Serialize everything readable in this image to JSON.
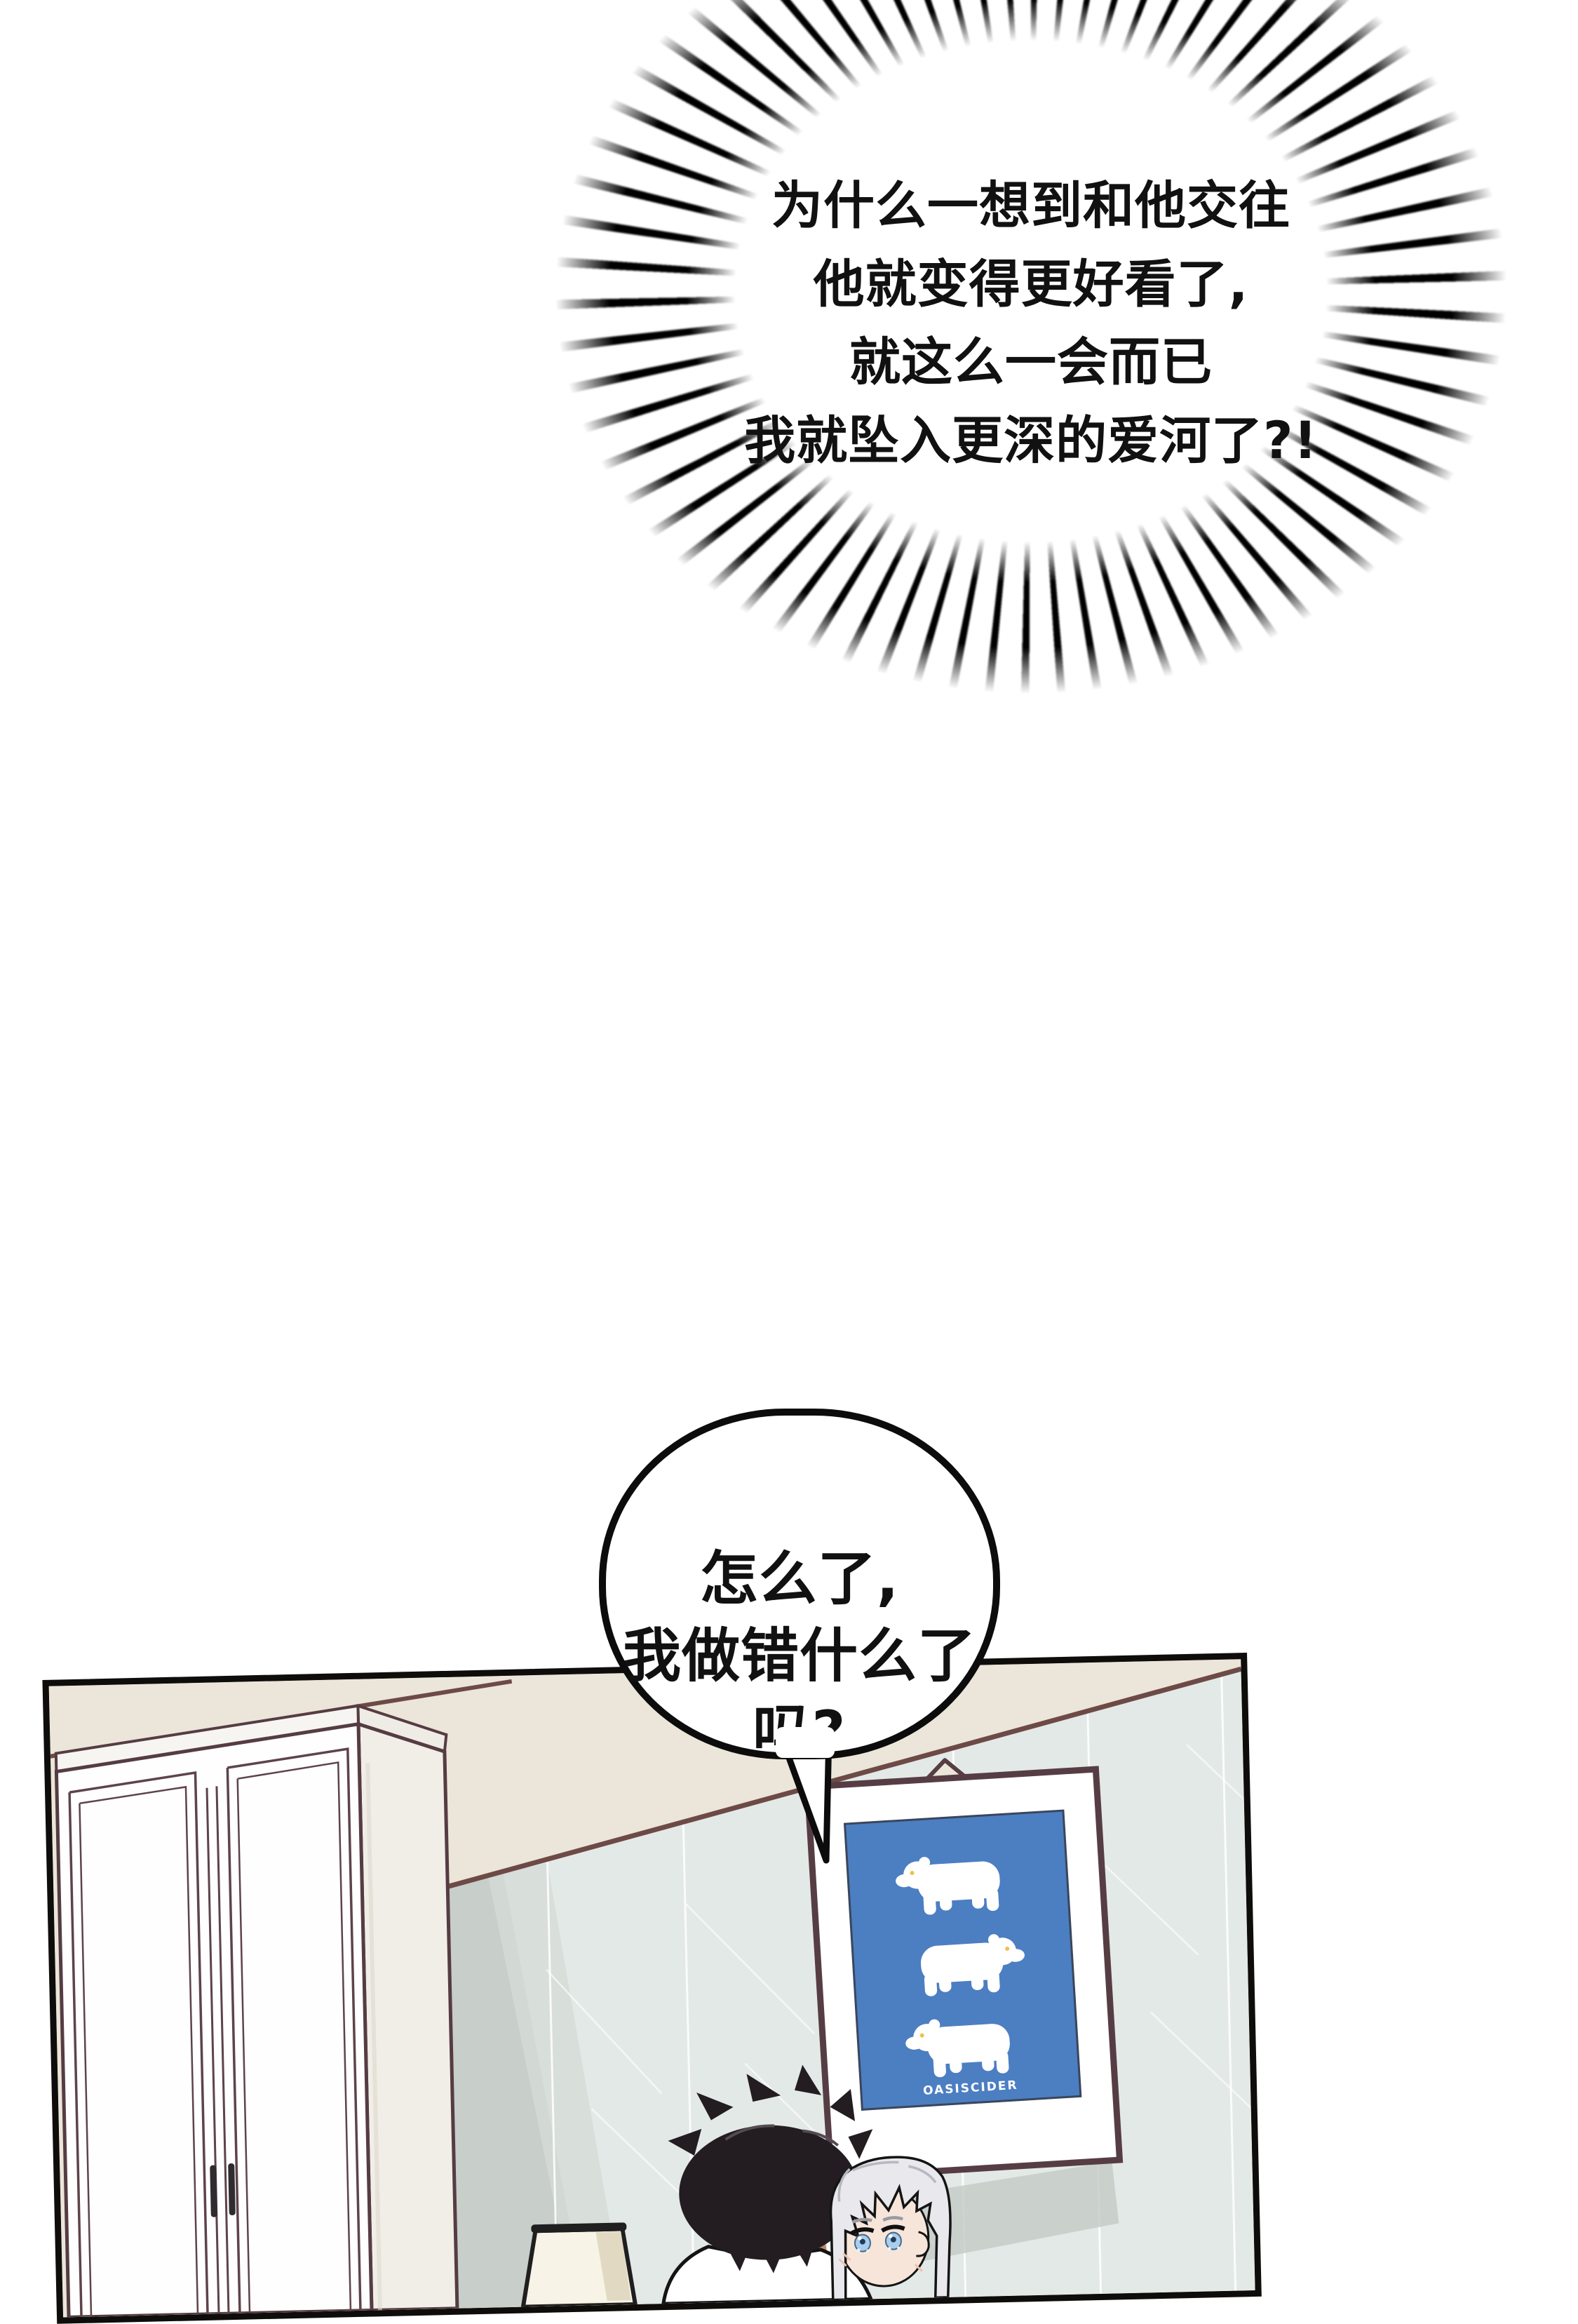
{
  "page": {
    "background_color": "#ffffff",
    "kind": "comic-page"
  },
  "burst_bubble": {
    "text": "为什么一想到和他交往\n他就变得更好看了,\n就这么一会而已\n我就坠入更深的爱河了?!",
    "line_color": "#000000",
    "text_color": "#111111"
  },
  "speech_bubble": {
    "text": "怎么了,\n我做错什么了吗?",
    "fill": "#ffffff",
    "border_color": "#0c0c0c",
    "text_color": "#111111"
  },
  "panel": {
    "border_color": "#0e0d0c",
    "upper_wall_color": "#ece5d9",
    "molding_color": "#6d4a46",
    "tile_wall_color": "#e3e9e7",
    "shadow_color": "#c8cec9",
    "wardrobe": {
      "front_color": "#fefefe",
      "side_color": "#f1eee8",
      "outline_color": "#553c43",
      "handle_color": "#2f2b2f"
    },
    "poster": {
      "caption": "OASISCIDER",
      "bear_count": 3,
      "frame_color": "#ffffff",
      "frame_outline_color": "#563d44",
      "poster_color": "#4c7ec2",
      "bear_color": "#ffffff",
      "caption_color": "#ffffff"
    },
    "lamp": {
      "shade_color": "#f7f3e6",
      "rim_color": "#1f1f1f"
    },
    "characters": {
      "dark_haired": {
        "hair_color": "#231d21",
        "skin_color": "#bb8763",
        "shirt_color": "#ffffff"
      },
      "silver_haired": {
        "hair_color": "#e9e9ed",
        "skin_color": "#f7e5da",
        "eye_color": "#a9cdec",
        "brow_color": "#9a9aa2"
      }
    }
  }
}
